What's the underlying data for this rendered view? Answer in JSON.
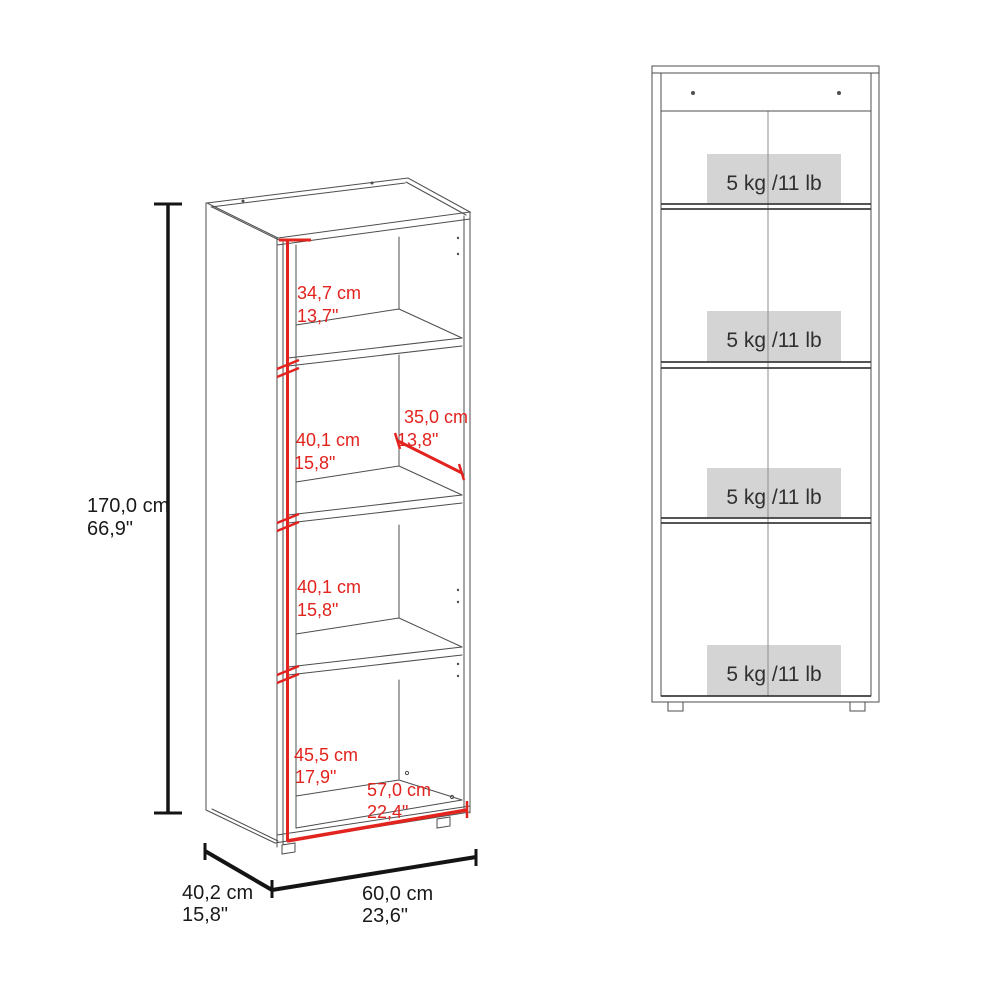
{
  "diagram": {
    "type": "furniture-dimension-drawing",
    "views": [
      "3d-perspective-with-dimensions",
      "front-view-with-shelf-capacities"
    ]
  },
  "left_view": {
    "height": {
      "cm": "170,0 cm",
      "inches": "66,9\""
    },
    "depth": {
      "cm": "40,2 cm",
      "inches": "15,8\""
    },
    "width": {
      "cm": "60,0 cm",
      "inches": "23,6\""
    },
    "compartment_1": {
      "cm": "34,7 cm",
      "inches": "13,7\""
    },
    "compartment_2": {
      "cm": "40,1 cm",
      "inches": "15,8\""
    },
    "compartment_3": {
      "cm": "40,1 cm",
      "inches": "15,8\""
    },
    "compartment_4": {
      "cm": "45,5 cm",
      "inches": "17,9\""
    },
    "shelf_depth": {
      "cm": "35,0 cm",
      "inches": "13,8\""
    },
    "interior_width": {
      "cm": "57,0 cm",
      "inches": "22,4\""
    }
  },
  "right_view": {
    "shelf_capacities": [
      "5 kg /11 lb",
      "5 kg /11 lb",
      "5 kg /11 lb",
      "5 kg /11 lb"
    ]
  },
  "colors": {
    "dimension_red": "#e2231e",
    "dimension_black": "#141414",
    "furniture_line": "#4d4d4d",
    "capacity_box_bg": "#d4d4d4",
    "capacity_text": "#303030",
    "background": "#ffffff"
  }
}
